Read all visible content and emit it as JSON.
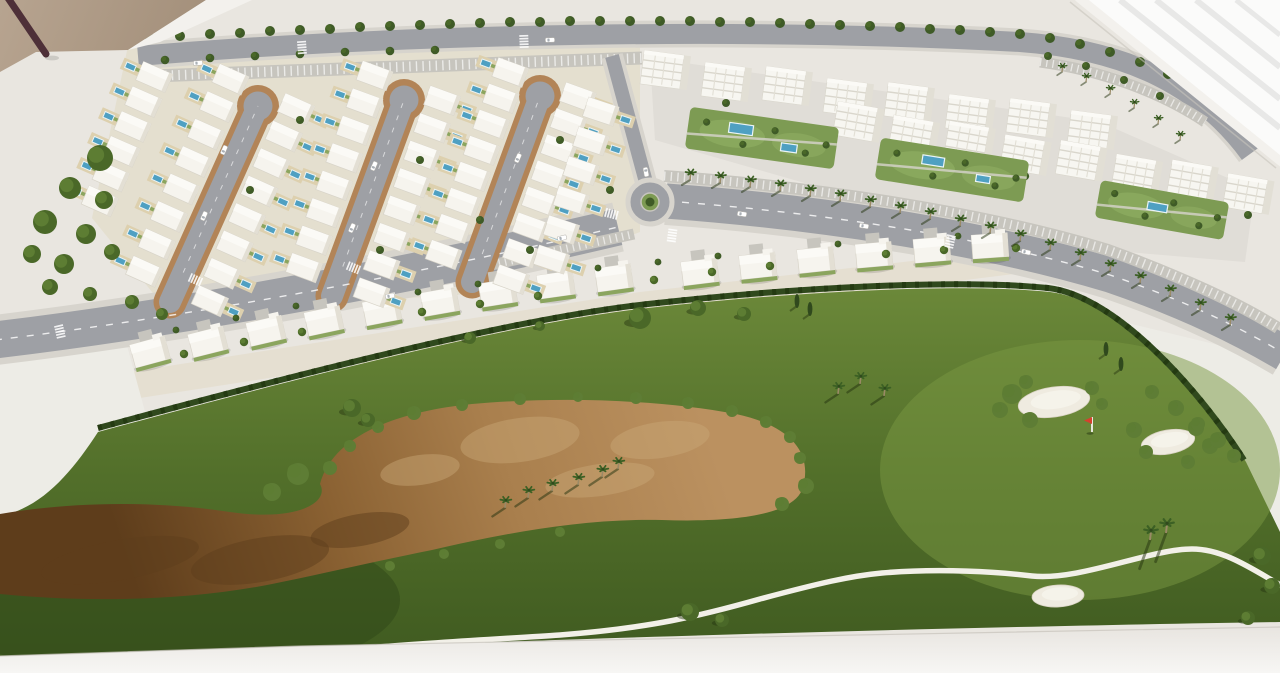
{
  "scene": {
    "title": "Architectural scale model — golf resort masterplan",
    "description": "Photograph of a white architectural scale model on a table: residential masterplan with cul-de-sac villa streets and pools, two rows of white apartment blocks with garden pools, a palm-lined avenue with a roundabout, and a golf course with a large sandy waste area, white bunkers, a red flag and winding cart paths."
  },
  "colors": {
    "base": "#e9e6e0",
    "plot": "#edece6",
    "table": "#efede9",
    "floor_a": "#b7a490",
    "floor_b": "#a28e79",
    "stick": "#4e3038",
    "window": "#fbfbfa",
    "window_streak": "#e8e8e7",
    "rim": "#f3f1ed",
    "band_a": "#e8e5e0",
    "band_b": "#f7f6f4",
    "band_line": "#c6c2ba",
    "road": "#9ea0a5",
    "road_light": "#c7c5be",
    "sidewalk": "#d7d4cd",
    "loop_brown": "#b28457",
    "villa": "#f6f4ee",
    "villa_stroke": "#d8d4c9",
    "villa_shade": "#e3dfd4",
    "roof": "#fbfaf6",
    "backyard": "#ddd0ae",
    "garden_line": "#8ba55e",
    "pool": "#4fa0c2",
    "pool_deck": "#eaf4f7",
    "apt": "#f7f6f1",
    "apt_shade": "#e2dfd5",
    "apt_line": "#d9d6cc",
    "garden": "#7d9b53",
    "garden_light": "#8fae62",
    "grass_hi": "#6b8839",
    "grass_mid": "#526f2a",
    "grass_lo": "#3f5a20",
    "grass_warm": "#7a9742",
    "rough_dark": "#31491a",
    "hedge": "#30491d",
    "hedge_dark": "#243a12",
    "tree_dark": "#3f5b27",
    "tree_mid": "#4a6828",
    "tree_light": "#5d7d33",
    "bush": "#5e7d35",
    "shadow_green": "#24330f",
    "sand_1": "#bb9160",
    "sand_2": "#a97f4d",
    "sand_3": "#8a6132",
    "sand_4": "#5e3d1b",
    "sand_patch": "#c9a878",
    "bunker": "#efebe0",
    "bunker_edge": "#d8d2c2",
    "path": "#f2f0e8",
    "palm_trunk": "#9a8a66",
    "palm_frond": "#3c6024",
    "car": "#ffffff",
    "car_glass": "#aab0b6",
    "car_stroke": "#b4b2ac",
    "flag_red": "#d6402e",
    "flag_pole": "#f5f4f0"
  },
  "residential": {
    "loops": [
      {
        "bx": 170,
        "by": 302,
        "tx": 258,
        "ty": 106
      },
      {
        "bx": 332,
        "by": 296,
        "tx": 404,
        "ty": 100
      },
      {
        "bx": 472,
        "by": 282,
        "tx": 540,
        "ty": 96
      }
    ],
    "villas_per_column": 8,
    "column_offset": 36,
    "extra_columns": [
      {
        "x1": 96,
        "y1": 210,
        "x2": 160,
        "y2": 64,
        "n": 6,
        "side": -1
      },
      {
        "x1": 548,
        "y1": 270,
        "x2": 606,
        "y2": 96,
        "n": 6,
        "side": 1
      }
    ],
    "district_trees": [
      [
        300,
        120
      ],
      [
        250,
        190
      ],
      [
        420,
        160
      ],
      [
        480,
        220
      ],
      [
        560,
        140
      ],
      [
        380,
        250
      ],
      [
        530,
        250
      ],
      [
        610,
        190
      ]
    ]
  },
  "mid_villas": [
    [
      150,
      352,
      -15
    ],
    [
      208,
      342,
      -14
    ],
    [
      266,
      331,
      -13
    ],
    [
      324,
      321,
      -12
    ],
    [
      382,
      311,
      -11
    ],
    [
      440,
      302,
      -10
    ],
    [
      498,
      293,
      -9
    ],
    [
      556,
      285,
      -8
    ],
    [
      614,
      278,
      -8
    ],
    [
      700,
      272,
      -7
    ],
    [
      758,
      266,
      -6
    ],
    [
      816,
      260,
      -6
    ],
    [
      874,
      255,
      -5
    ],
    [
      932,
      250,
      -5
    ],
    [
      990,
      246,
      -4
    ]
  ],
  "apartments": {
    "row_a": {
      "x1": 665,
      "y1": 72,
      "x2": 1092,
      "y2": 128,
      "n": 8
    },
    "row_b": {
      "x1": 858,
      "y1": 124,
      "x2": 1248,
      "y2": 192,
      "n": 8
    },
    "gardens": [
      {
        "cx": 762,
        "cy": 138,
        "rot": 8,
        "w": 150,
        "h": 42,
        "pools": [
          [
            -22,
            -6,
            24,
            10
          ],
          [
            28,
            6,
            16,
            8
          ]
        ]
      },
      {
        "cx": 952,
        "cy": 170,
        "rot": 9,
        "w": 150,
        "h": 42,
        "pools": [
          [
            -20,
            -6,
            22,
            9
          ],
          [
            32,
            4,
            14,
            7
          ]
        ]
      },
      {
        "cx": 1162,
        "cy": 210,
        "rot": 10,
        "w": 130,
        "h": 38,
        "pools": [
          [
            -5,
            -2,
            20,
            8
          ]
        ]
      }
    ]
  },
  "vegetation": {
    "top_tree_row": [
      [
        150,
        38
      ],
      [
        180,
        36
      ],
      [
        210,
        34
      ],
      [
        240,
        33
      ],
      [
        270,
        31
      ],
      [
        300,
        30
      ],
      [
        330,
        29
      ],
      [
        360,
        27
      ],
      [
        390,
        26
      ],
      [
        420,
        25
      ],
      [
        450,
        24
      ],
      [
        480,
        23
      ],
      [
        510,
        22
      ],
      [
        540,
        22
      ],
      [
        570,
        21
      ],
      [
        600,
        21
      ],
      [
        630,
        21
      ],
      [
        660,
        21
      ],
      [
        690,
        21
      ],
      [
        720,
        22
      ],
      [
        750,
        22
      ],
      [
        780,
        23
      ],
      [
        810,
        24
      ],
      [
        840,
        25
      ],
      [
        870,
        26
      ],
      [
        900,
        27
      ],
      [
        930,
        29
      ],
      [
        960,
        30
      ],
      [
        990,
        32
      ],
      [
        1020,
        34
      ],
      [
        1050,
        38
      ],
      [
        1080,
        44
      ],
      [
        1110,
        52
      ],
      [
        1140,
        62
      ],
      [
        1168,
        74
      ],
      [
        1195,
        88
      ],
      [
        1220,
        104
      ],
      [
        1242,
        122
      ]
    ],
    "second_tree_row": [
      [
        165,
        60
      ],
      [
        210,
        58
      ],
      [
        255,
        56
      ],
      [
        300,
        54
      ],
      [
        345,
        52
      ],
      [
        390,
        51
      ],
      [
        435,
        50
      ]
    ],
    "left_clumps": [
      [
        100,
        158,
        13
      ],
      [
        70,
        188,
        11
      ],
      [
        104,
        200,
        9
      ],
      [
        45,
        222,
        12
      ],
      [
        86,
        234,
        10
      ],
      [
        32,
        254,
        9
      ],
      [
        64,
        264,
        10
      ],
      [
        112,
        252,
        8
      ],
      [
        50,
        287,
        8
      ],
      [
        90,
        294,
        7
      ],
      [
        132,
        302,
        7
      ],
      [
        162,
        314,
        6
      ]
    ],
    "strip_trees": [
      [
        176,
        330
      ],
      [
        236,
        318
      ],
      [
        296,
        306
      ],
      [
        418,
        292
      ],
      [
        478,
        284
      ],
      [
        598,
        268
      ],
      [
        658,
        262
      ],
      [
        718,
        256
      ],
      [
        838,
        244
      ],
      [
        958,
        236
      ]
    ],
    "villa_row_trees": [
      [
        184,
        354
      ],
      [
        244,
        342
      ],
      [
        302,
        332
      ],
      [
        422,
        312
      ],
      [
        480,
        304
      ],
      [
        538,
        296
      ],
      [
        654,
        280
      ],
      [
        712,
        272
      ],
      [
        770,
        266
      ],
      [
        886,
        254
      ],
      [
        944,
        250
      ],
      [
        1016,
        248
      ]
    ],
    "avenue_palms": [
      [
        690,
        180
      ],
      [
        720,
        183
      ],
      [
        750,
        187
      ],
      [
        780,
        191
      ],
      [
        810,
        196
      ],
      [
        840,
        201
      ],
      [
        870,
        207
      ],
      [
        900,
        213
      ],
      [
        930,
        219
      ],
      [
        960,
        226
      ],
      [
        990,
        233
      ],
      [
        1020,
        241
      ],
      [
        1050,
        250
      ],
      [
        1080,
        260
      ],
      [
        1110,
        271
      ],
      [
        1140,
        283
      ],
      [
        1170,
        296
      ],
      [
        1200,
        310
      ],
      [
        1230,
        325
      ]
    ],
    "upper_right_palms": [
      [
        1062,
        72
      ],
      [
        1086,
        82
      ],
      [
        1110,
        94
      ],
      [
        1134,
        108
      ],
      [
        1158,
        124
      ],
      [
        1180,
        140
      ]
    ],
    "apartment_trees": [
      [
        1048,
        56
      ],
      [
        1086,
        66
      ],
      [
        1124,
        80
      ],
      [
        1160,
        96
      ]
    ]
  },
  "golf": {
    "trees": [
      [
        352,
        408,
        9
      ],
      [
        368,
        420,
        7
      ],
      [
        640,
        318,
        11
      ],
      [
        698,
        308,
        8
      ],
      [
        744,
        314,
        7
      ],
      [
        470,
        338,
        6
      ],
      [
        540,
        326,
        5
      ],
      [
        690,
        612,
        9
      ],
      [
        722,
        620,
        7
      ],
      [
        1262,
        556,
        9
      ],
      [
        1272,
        586,
        8
      ],
      [
        1248,
        618,
        7
      ]
    ],
    "cypresses": [
      [
        797,
        306
      ],
      [
        810,
        314
      ],
      [
        1106,
        354
      ],
      [
        1121,
        369
      ]
    ],
    "palms": [
      [
        505,
        508
      ],
      [
        528,
        498
      ],
      [
        552,
        491
      ],
      [
        578,
        485
      ],
      [
        602,
        477
      ],
      [
        618,
        469
      ],
      [
        838,
        394
      ],
      [
        860,
        384
      ],
      [
        884,
        396
      ]
    ],
    "bottom_palms": [
      [
        1150,
        540
      ],
      [
        1166,
        533
      ]
    ],
    "sand_bushes": [
      [
        330,
        468,
        7
      ],
      [
        350,
        446,
        6
      ],
      [
        378,
        427,
        6
      ],
      [
        414,
        413,
        7
      ],
      [
        462,
        405,
        6
      ],
      [
        520,
        399,
        6
      ],
      [
        578,
        397,
        5
      ],
      [
        636,
        398,
        6
      ],
      [
        688,
        403,
        6
      ],
      [
        732,
        411,
        6
      ],
      [
        766,
        422,
        6
      ],
      [
        790,
        437,
        6
      ],
      [
        800,
        458,
        6
      ],
      [
        298,
        474,
        11
      ],
      [
        272,
        492,
        9
      ],
      [
        806,
        486,
        8
      ],
      [
        782,
        504,
        7
      ]
    ],
    "sand_bushes_lower": [
      [
        560,
        532,
        5
      ],
      [
        500,
        544,
        5
      ],
      [
        444,
        554,
        5
      ],
      [
        390,
        566,
        5
      ]
    ],
    "sand_patches": [
      [
        520,
        440,
        60,
        22
      ],
      [
        660,
        440,
        50,
        18
      ],
      [
        420,
        470,
        40,
        15
      ],
      [
        600,
        480,
        55,
        16
      ]
    ],
    "sand_dark": [
      [
        260,
        560,
        70,
        22
      ],
      [
        120,
        560,
        80,
        20
      ],
      [
        360,
        530,
        50,
        16
      ]
    ],
    "rim_bushes": [
      [
        1152,
        392,
        7
      ],
      [
        1176,
        408,
        8
      ],
      [
        1198,
        424,
        7
      ],
      [
        1218,
        440,
        8
      ],
      [
        1234,
        456,
        7
      ]
    ],
    "bunkers": [
      {
        "cx": 1054,
        "cy": 402,
        "rx": 36,
        "ry": 15,
        "rot": -8
      },
      {
        "cx": 1168,
        "cy": 442,
        "rx": 27,
        "ry": 12,
        "rot": -10
      },
      {
        "cx": 1058,
        "cy": 596,
        "rx": 26,
        "ry": 11,
        "rot": -3
      }
    ],
    "bunker_bushes": [
      [
        1012,
        394,
        10
      ],
      [
        1000,
        410,
        8
      ],
      [
        1030,
        420,
        8
      ],
      [
        1026,
        382,
        7
      ],
      [
        1092,
        388,
        7
      ],
      [
        1102,
        404,
        6
      ],
      [
        1134,
        430,
        8
      ],
      [
        1146,
        452,
        7
      ],
      [
        1196,
        428,
        8
      ],
      [
        1210,
        446,
        8
      ],
      [
        1188,
        462,
        7
      ]
    ],
    "flag": {
      "x": 1092,
      "y": 432,
      "pole_h": 15
    }
  },
  "traffic": {
    "cars": [
      [
        224,
        150,
        -66
      ],
      [
        204,
        216,
        -66
      ],
      [
        374,
        166,
        -66
      ],
      [
        352,
        228,
        -66
      ],
      [
        518,
        158,
        -66
      ],
      [
        390,
        296,
        -12
      ],
      [
        562,
        238,
        -14
      ],
      [
        742,
        214,
        8
      ],
      [
        1026,
        252,
        13
      ],
      [
        198,
        63,
        -4
      ],
      [
        550,
        40,
        -2
      ],
      [
        864,
        226,
        9
      ],
      [
        646,
        172,
        80
      ]
    ],
    "crosswalks": [
      [
        196,
        280,
        24
      ],
      [
        354,
        268,
        22
      ],
      [
        612,
        214,
        15
      ],
      [
        672,
        236,
        98
      ],
      [
        302,
        48,
        86
      ],
      [
        524,
        42,
        88
      ],
      [
        60,
        332,
        77
      ],
      [
        950,
        242,
        103
      ]
    ]
  }
}
